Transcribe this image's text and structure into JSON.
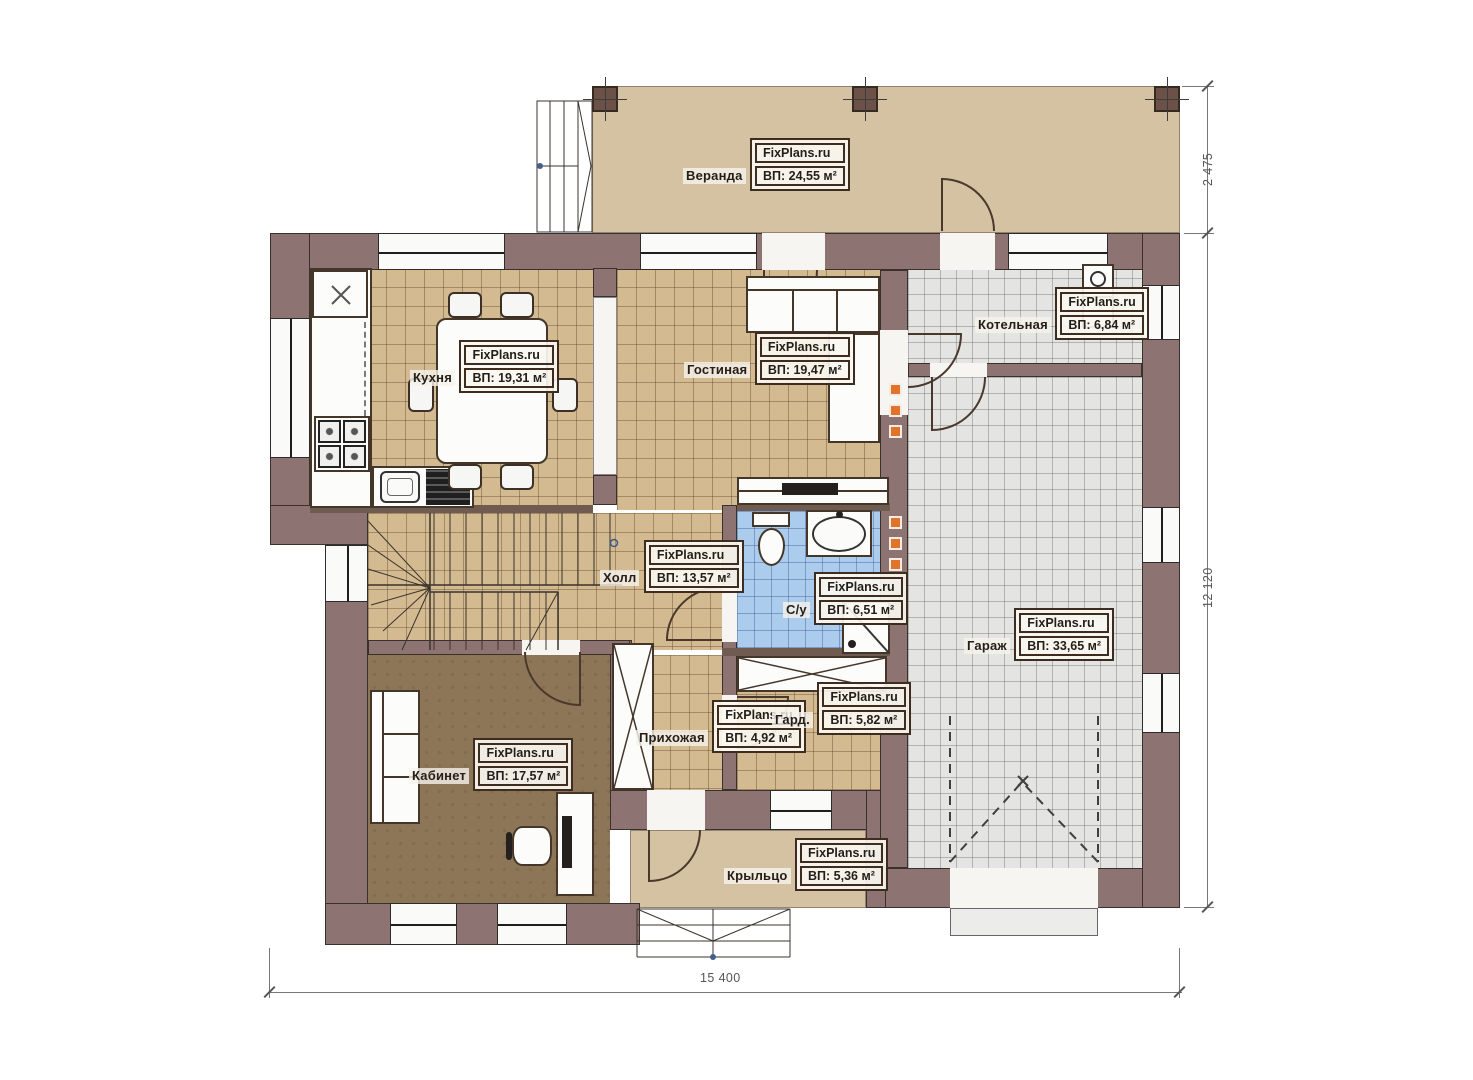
{
  "brand": "FixPlans.ru",
  "rooms": [
    {
      "name": "Веранда",
      "area": "ВП: 24,55 м²"
    },
    {
      "name": "Кухня",
      "area": "ВП: 19,31 м²"
    },
    {
      "name": "Гостиная",
      "area": "ВП: 19,47 м²"
    },
    {
      "name": "Котельная",
      "area": "ВП: 6,84 м²"
    },
    {
      "name": "Холл",
      "area": "ВП: 13,57 м²"
    },
    {
      "name": "С/у",
      "area": "ВП: 6,51 м²"
    },
    {
      "name": "Гараж",
      "area": "ВП: 33,65 м²"
    },
    {
      "name": "Кабинет",
      "area": "ВП: 17,57 м²"
    },
    {
      "name": "Прихожая",
      "area": "ВП: 4,92 м²"
    },
    {
      "name": "Гард.",
      "area": "ВП: 5,82 м²"
    },
    {
      "name": "Крыльцо",
      "area": "ВП: 5,36 м²"
    }
  ],
  "dimensions": {
    "bottom": "15 400",
    "right": "12 120",
    "top_right": "2 475"
  },
  "colors": {
    "wall": "#8d7472",
    "floor_tile_tan": "#d3ba90",
    "floor_tile_gray": "#e4e4e2",
    "floor_tile_blue": "#abccec",
    "floor_office": "#8d7557",
    "veranda_floor": "#d5c2a2",
    "vent_accent": "#e2732d"
  }
}
